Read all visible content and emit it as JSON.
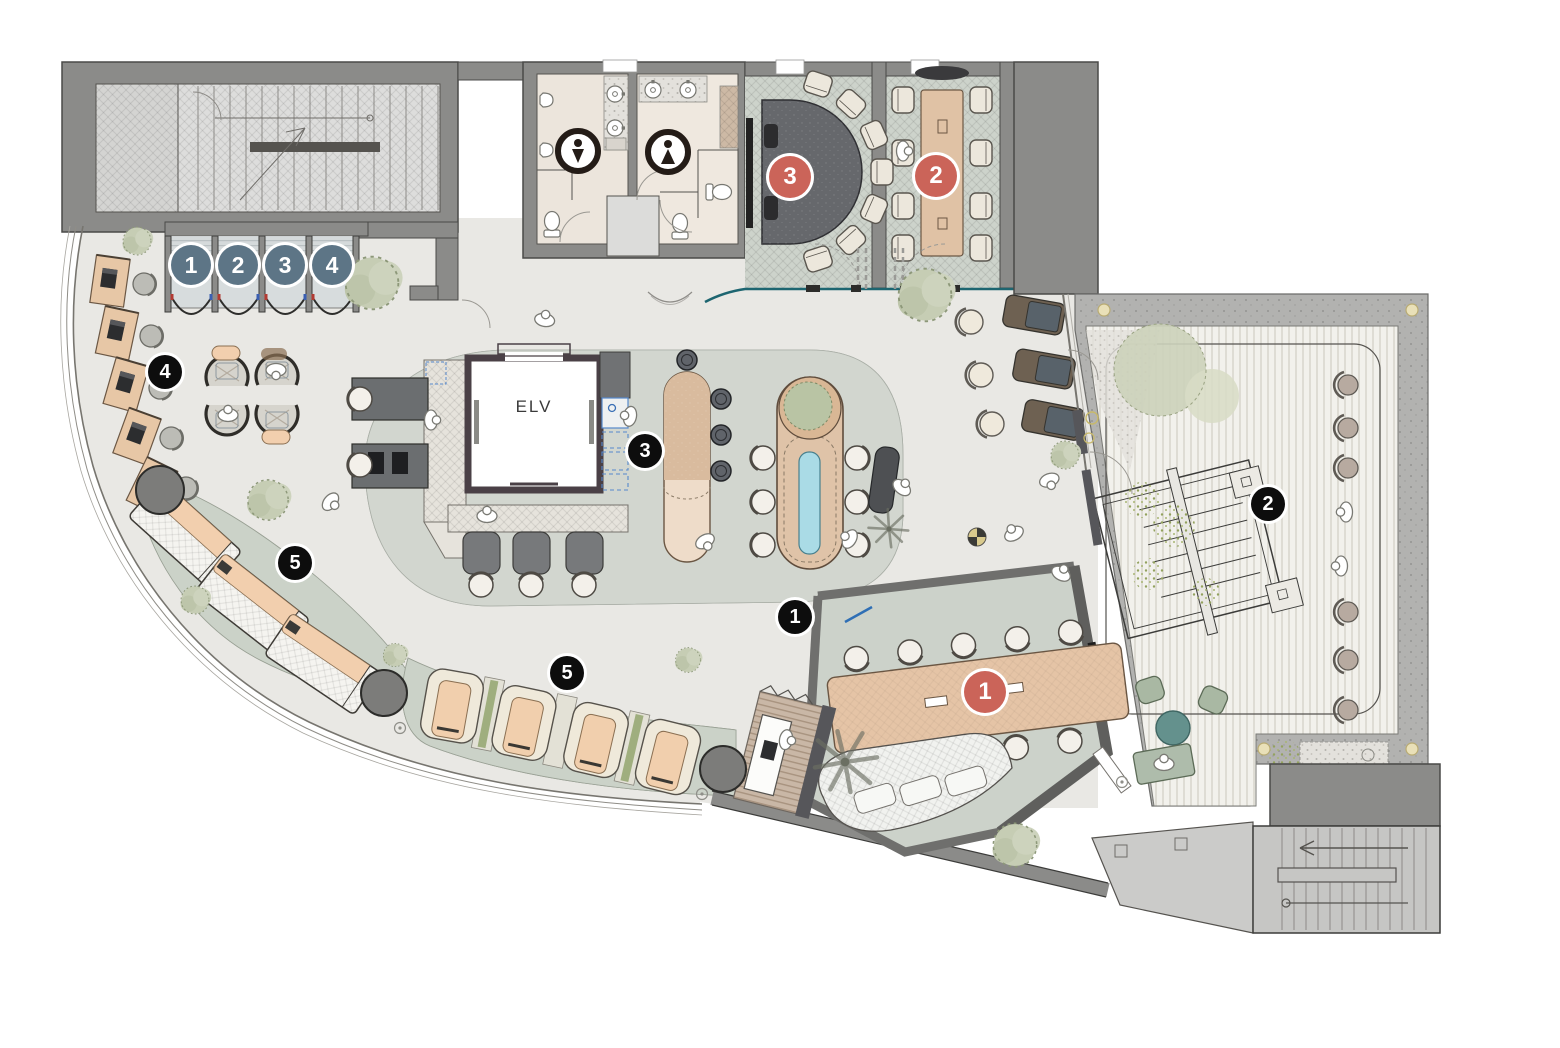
{
  "plan": {
    "elevator_label": "ELV",
    "marker_styles": {
      "zone": {
        "bg": "#0d0d0d",
        "fg": "#ffffff",
        "size": 34
      },
      "room": {
        "bg": "#cb6459",
        "fg": "#ffffff",
        "size": 42
      },
      "booth": {
        "bg": "#5d7586",
        "fg": "#ffffff",
        "size": 40
      }
    },
    "markers": [
      {
        "style": "booth",
        "label": "1",
        "x": 191,
        "y": 265
      },
      {
        "style": "booth",
        "label": "2",
        "x": 238,
        "y": 265
      },
      {
        "style": "booth",
        "label": "3",
        "x": 285,
        "y": 265
      },
      {
        "style": "booth",
        "label": "4",
        "x": 332,
        "y": 265
      },
      {
        "style": "room",
        "label": "3",
        "x": 790,
        "y": 177
      },
      {
        "style": "room",
        "label": "2",
        "x": 936,
        "y": 176
      },
      {
        "style": "room",
        "label": "1",
        "x": 985,
        "y": 692
      },
      {
        "style": "zone",
        "label": "4",
        "x": 165,
        "y": 372
      },
      {
        "style": "zone",
        "label": "3",
        "x": 645,
        "y": 451
      },
      {
        "style": "zone",
        "label": "5",
        "x": 295,
        "y": 563
      },
      {
        "style": "zone",
        "label": "5",
        "x": 567,
        "y": 673
      },
      {
        "style": "zone",
        "label": "1",
        "x": 795,
        "y": 617
      },
      {
        "style": "zone",
        "label": "2",
        "x": 1268,
        "y": 504
      }
    ],
    "icons": [
      {
        "name": "mens-restroom-icon",
        "x": 578,
        "y": 151
      },
      {
        "name": "womens-restroom-icon",
        "x": 668,
        "y": 152
      }
    ]
  }
}
